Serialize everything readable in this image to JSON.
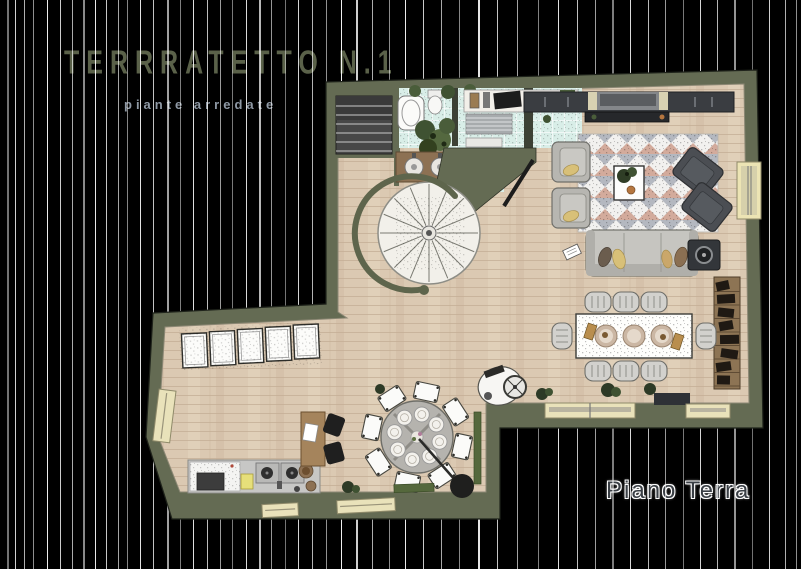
{
  "header": {
    "title": "TERRRATETTO N.1",
    "subtitle": "piante arredate"
  },
  "floor_label": "Piano Terra",
  "colors": {
    "background": "#000000",
    "wall": "#646b53",
    "floor_wood": "#dbc9b2",
    "bathroom_tile": "#d9eee8",
    "window_frame": "#e9e2ba",
    "title_text": "#5a6149",
    "subtitle_text": "#8e98a4",
    "floor_label_text": "#3a3f45"
  },
  "plan": {
    "floor_name": "Piano Terra",
    "rooms": [
      {
        "name": "bathroom"
      },
      {
        "name": "utility-room"
      },
      {
        "name": "living-room"
      },
      {
        "name": "dining-area"
      },
      {
        "name": "kitchen"
      }
    ],
    "features": [
      "entry-staircase",
      "spiral-staircase",
      "sofa",
      "armchairs",
      "lounge-chairs",
      "patterned-rug",
      "tv-console",
      "speaker-table",
      "dining-table-8-seats",
      "round-table-8-seats",
      "kitchen-counter",
      "small-desk",
      "sideboard-cabinets",
      "bookshelf",
      "windows",
      "plants",
      "pendant-lamp",
      "exercise-bike",
      "vanity-two-sinks",
      "bathtub",
      "door"
    ]
  }
}
